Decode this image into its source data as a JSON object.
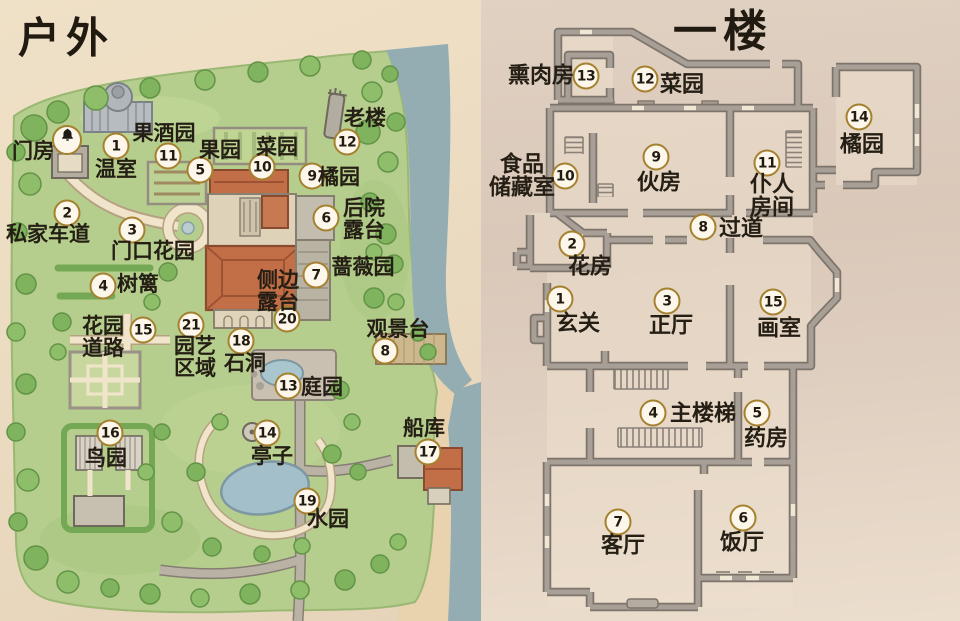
{
  "left_map": {
    "title": "户外",
    "locations": [
      {
        "n": "bell",
        "label": "门房",
        "mx": 67,
        "my": 140,
        "lx": 33,
        "ly": 151
      },
      {
        "n": "1",
        "label": "温室",
        "mx": 116,
        "my": 146,
        "lx": 116,
        "ly": 169
      },
      {
        "n": "11",
        "label": "果酒园",
        "mx": 168,
        "my": 156,
        "lx": 164,
        "ly": 133
      },
      {
        "n": "5",
        "label": "果园",
        "mx": 200,
        "my": 170,
        "lx": 220,
        "ly": 150
      },
      {
        "n": "10",
        "label": "菜园",
        "mx": 262,
        "my": 167,
        "lx": 277,
        "ly": 147
      },
      {
        "n": "12",
        "label": "老楼",
        "mx": 347,
        "my": 142,
        "lx": 365,
        "ly": 118
      },
      {
        "n": "9",
        "label": "橘园",
        "mx": 312,
        "my": 176,
        "lx": 339,
        "ly": 177
      },
      {
        "n": "6",
        "label": "后院\n露台",
        "mx": 326,
        "my": 218,
        "lx": 364,
        "ly": 219
      },
      {
        "n": "7",
        "label": "蔷薇园",
        "mx": 316,
        "my": 275,
        "lx": 363,
        "ly": 267
      },
      {
        "n": "20",
        "label": "侧边\n露台",
        "mx": 287,
        "my": 319,
        "lx": 278,
        "ly": 291
      },
      {
        "n": "2",
        "label": "私家车道",
        "mx": 67,
        "my": 213,
        "lx": 48,
        "ly": 234
      },
      {
        "n": "3",
        "label": "门口花园",
        "mx": 132,
        "my": 230,
        "lx": 153,
        "ly": 251
      },
      {
        "n": "4",
        "label": "树篱",
        "mx": 103,
        "my": 286,
        "lx": 138,
        "ly": 284
      },
      {
        "n": "15",
        "label": "花园\n道路",
        "mx": 143,
        "my": 330,
        "lx": 103,
        "ly": 337
      },
      {
        "n": "21",
        "label": "园艺\n区域",
        "mx": 191,
        "my": 325,
        "lx": 195,
        "ly": 357
      },
      {
        "n": "18",
        "label": "石洞",
        "mx": 241,
        "my": 341,
        "lx": 245,
        "ly": 363
      },
      {
        "n": "13",
        "label": "庭园",
        "mx": 288,
        "my": 386,
        "lx": 322,
        "ly": 387
      },
      {
        "n": "8",
        "label": "观景台",
        "mx": 385,
        "my": 351,
        "lx": 398,
        "ly": 329
      },
      {
        "n": "16",
        "label": "鸟园",
        "mx": 110,
        "my": 433,
        "lx": 106,
        "ly": 458
      },
      {
        "n": "14",
        "label": "亭子",
        "mx": 267,
        "my": 433,
        "lx": 272,
        "ly": 456
      },
      {
        "n": "19",
        "label": "水园",
        "mx": 307,
        "my": 501,
        "lx": 328,
        "ly": 519
      },
      {
        "n": "17",
        "label": "船库",
        "mx": 428,
        "my": 452,
        "lx": 424,
        "ly": 428
      }
    ]
  },
  "right_map": {
    "title": "一楼",
    "rooms": [
      {
        "n": "13",
        "label": "熏肉房",
        "mx": 586,
        "my": 76,
        "lx": 541,
        "ly": 75
      },
      {
        "n": "12",
        "label": "菜园",
        "mx": 645,
        "my": 79,
        "lx": 682,
        "ly": 84
      },
      {
        "n": "14",
        "label": "橘园",
        "mx": 859,
        "my": 117,
        "lx": 862,
        "ly": 144
      },
      {
        "n": "10",
        "label": "食品\n储藏室",
        "mx": 565,
        "my": 176,
        "lx": 522,
        "ly": 176
      },
      {
        "n": "9",
        "label": "伙房",
        "mx": 656,
        "my": 157,
        "lx": 659,
        "ly": 182
      },
      {
        "n": "11",
        "label": "仆人\n房间",
        "mx": 767,
        "my": 163,
        "lx": 772,
        "ly": 196
      },
      {
        "n": "8",
        "label": "过道",
        "mx": 703,
        "my": 227,
        "lx": 741,
        "ly": 228
      },
      {
        "n": "2",
        "label": "花房",
        "mx": 572,
        "my": 244,
        "lx": 590,
        "ly": 266
      },
      {
        "n": "1",
        "label": "玄关",
        "mx": 560,
        "my": 299,
        "lx": 578,
        "ly": 323
      },
      {
        "n": "3",
        "label": "正厅",
        "mx": 667,
        "my": 301,
        "lx": 671,
        "ly": 325
      },
      {
        "n": "15",
        "label": "画室",
        "mx": 773,
        "my": 302,
        "lx": 779,
        "ly": 328
      },
      {
        "n": "4",
        "label": "主楼梯",
        "mx": 653,
        "my": 413,
        "lx": 703,
        "ly": 413
      },
      {
        "n": "5",
        "label": "药房",
        "mx": 757,
        "my": 413,
        "lx": 766,
        "ly": 438
      },
      {
        "n": "7",
        "label": "客厅",
        "mx": 618,
        "my": 522,
        "lx": 623,
        "ly": 545
      },
      {
        "n": "6",
        "label": "饭厅",
        "mx": 743,
        "my": 518,
        "lx": 742,
        "ly": 542
      }
    ]
  },
  "colors": {
    "marker_ring": "#a5812f",
    "marker_fill": "#fcf7ea",
    "ink": "#241e14",
    "wall_gray": "#a8a096",
    "wall_outline": "#7d746b",
    "grass": "#b5ce8d",
    "tree_green": "#7fb35e",
    "water": "#93adb3",
    "path_cream": "#f0e5ca",
    "roof_orange": "#c26f48",
    "paper": "#ecdcc2"
  }
}
